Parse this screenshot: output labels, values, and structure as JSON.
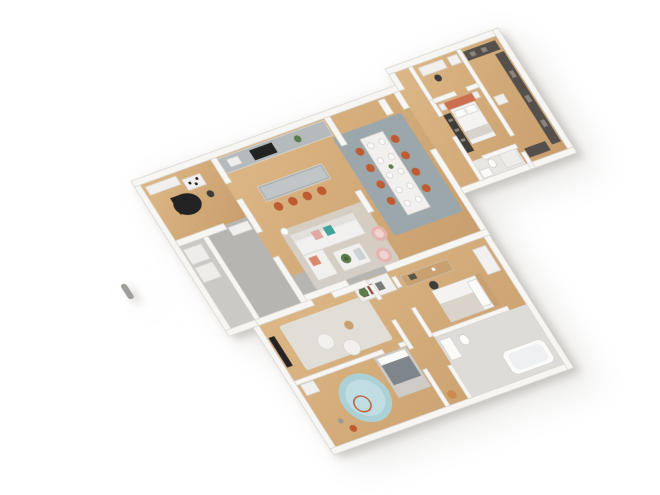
{
  "scene": {
    "kind": "isometric-3d-floor-plan-render",
    "rooms": [
      "office-music-room",
      "utility-room",
      "entry-hall",
      "kitchen",
      "dining-area",
      "living-room",
      "hallway-connector",
      "dressing-room",
      "master-bedroom",
      "walk-in-closet",
      "ensuite-bathroom",
      "tv-den",
      "kids-bedroom",
      "guest-bedroom",
      "bathroom",
      "south-corridor"
    ],
    "furniture": [
      "kitchen-counter",
      "cooktop",
      "kitchen-island",
      "bar-stools",
      "dining-table",
      "dining-chairs",
      "place-settings",
      "sofa",
      "coffee-table",
      "armchairs",
      "floor-lamp",
      "pantry-shelf",
      "grand-piano",
      "office-table",
      "washer",
      "dryer",
      "double-bed",
      "wardrobes",
      "closet-rails",
      "desk",
      "desk-chair",
      "tv-screen",
      "poufs",
      "round-rug",
      "kids-bed",
      "bathtub",
      "sink",
      "toilet",
      "plants",
      "toy-ring",
      "flue-pipe"
    ]
  },
  "palette": {
    "background": "#ffffff",
    "wall": "#f7f6f3",
    "wall_edge": "#d8d5d1",
    "wood": "#c89e6c",
    "wood_light": "#ddb886",
    "wood_mid": "#c9a06f",
    "floor_gray": "#b7b5b2",
    "utility_floor": "#cbc9c6",
    "bath_floor": "#dedcd9",
    "ensuite_floor": "#e8e6e3",
    "counter": "#b5bbbd",
    "island": "#a9b0b2",
    "island_top": "#c0c6c8",
    "rug_gray": "#9ba7aa",
    "rug_living": "#d6d0c9",
    "rug_den": "#e1ddd7",
    "rug_teal": "#abd1d7",
    "rug_teal_inner": "#bfdde2",
    "accent_orange": "#bf5b31",
    "coral": "#cb6f4e",
    "cushion_pink": "#e0a9a4",
    "chair_pink": "#e4b5b0",
    "chair_pink_inner": "#eed3cf",
    "cushion_coral": "#d88a6e",
    "teal": "#41a49c",
    "dark": "#232323",
    "dark_soft": "#3f3d3a",
    "closet_dark": "#55504b",
    "closet_light": "#8b857e",
    "white_furniture": "#f1f0ee",
    "sofa_back": "#e3e1dd",
    "bed_white": "#f4f3f1",
    "pillow_white": "#fbfbfa",
    "plate_white": "#fafaf8",
    "duvet_gray": "#7f868b",
    "blanket_beige": "#d9d3cb",
    "throw_gray": "#d8d2ca",
    "book_gray": "#ccd1d3",
    "green": "#5d7c4e",
    "green_dark": "#46613a",
    "metal_gray": "#a09e9b",
    "appliance": "#eeedeb",
    "frame_gray": "#cfccc8"
  }
}
